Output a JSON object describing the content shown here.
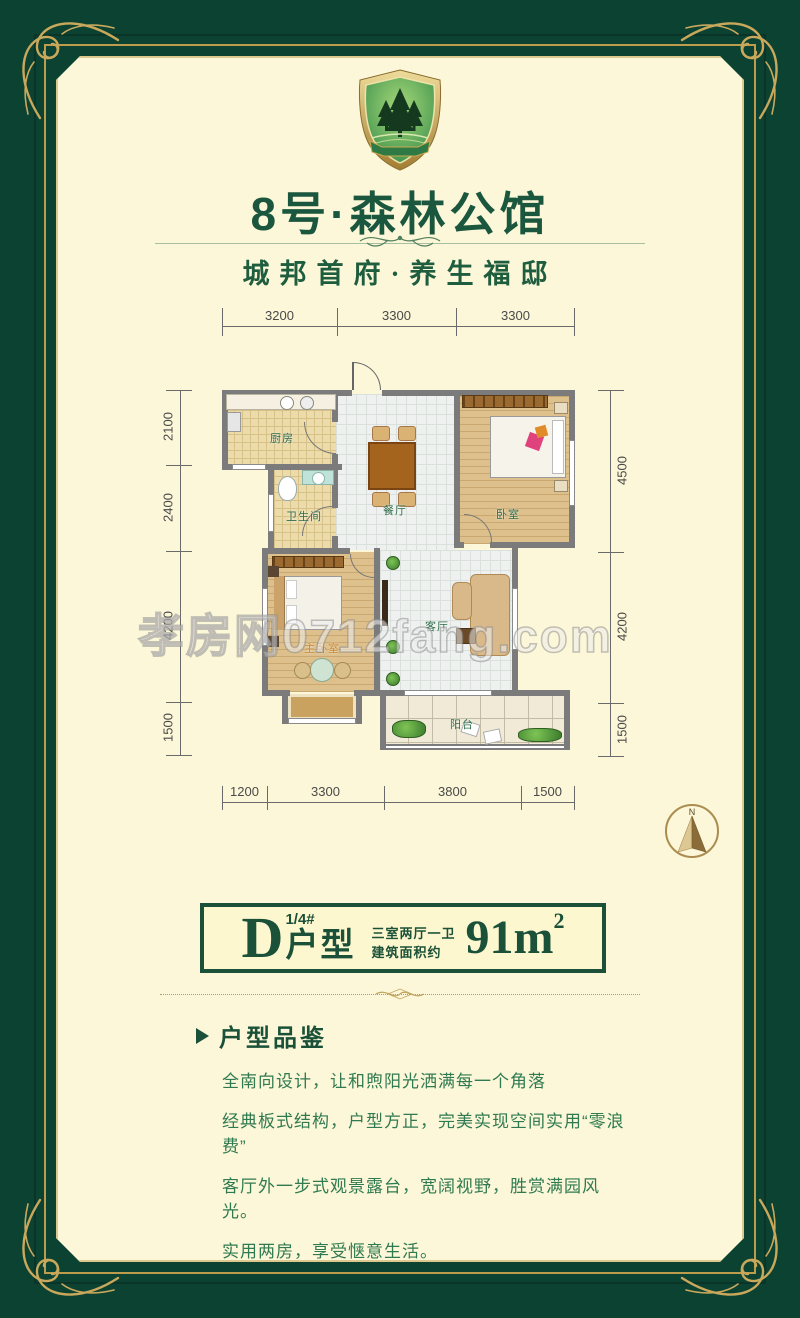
{
  "brand": {
    "logo": "forest-shield-logo",
    "title": "8号·森林公馆",
    "subtitle": "城邦首府·养生福邸"
  },
  "plan": {
    "rooms": {
      "kitchen": "厨房",
      "bathroom": "卫生间",
      "dining": "餐厅",
      "bedroom": "卧室",
      "master_bedroom": "主卧室",
      "living": "客厅",
      "balcony": "阳台"
    },
    "dims": {
      "top": [
        "3200",
        "3300",
        "3300"
      ],
      "bottom": [
        "1200",
        "3300",
        "3800",
        "1500"
      ],
      "left": [
        "2100",
        "2400",
        "4200",
        "1500"
      ],
      "right": [
        "4500",
        "4200",
        "1500"
      ]
    },
    "compass_label": "N",
    "watermark": "孝房网0712fang.com"
  },
  "badge": {
    "letter": "D",
    "superscript": "1/4#",
    "suffix": "户型",
    "spec_top": "三室两厅一卫",
    "spec_bottom": "建筑面积约",
    "area": "91m",
    "area_exp": "2"
  },
  "review": {
    "title": "户型品鉴",
    "lines": [
      "全南向设计，让和煦阳光洒满每一个角落",
      "经典板式结构，户型方正，完美实现空间实用“零浪费”",
      "客厅外一步式观景露台，宽阔视野，胜赏满园风光。",
      "实用两房，享受惬意生活。"
    ]
  },
  "colors": {
    "frame_green": "#0b4231",
    "gold": "#c9a85c",
    "cream": "#fcf7d8",
    "title_green": "#1b573e",
    "text_green": "#2f7a50",
    "wall_gray": "#7b7b7b"
  }
}
